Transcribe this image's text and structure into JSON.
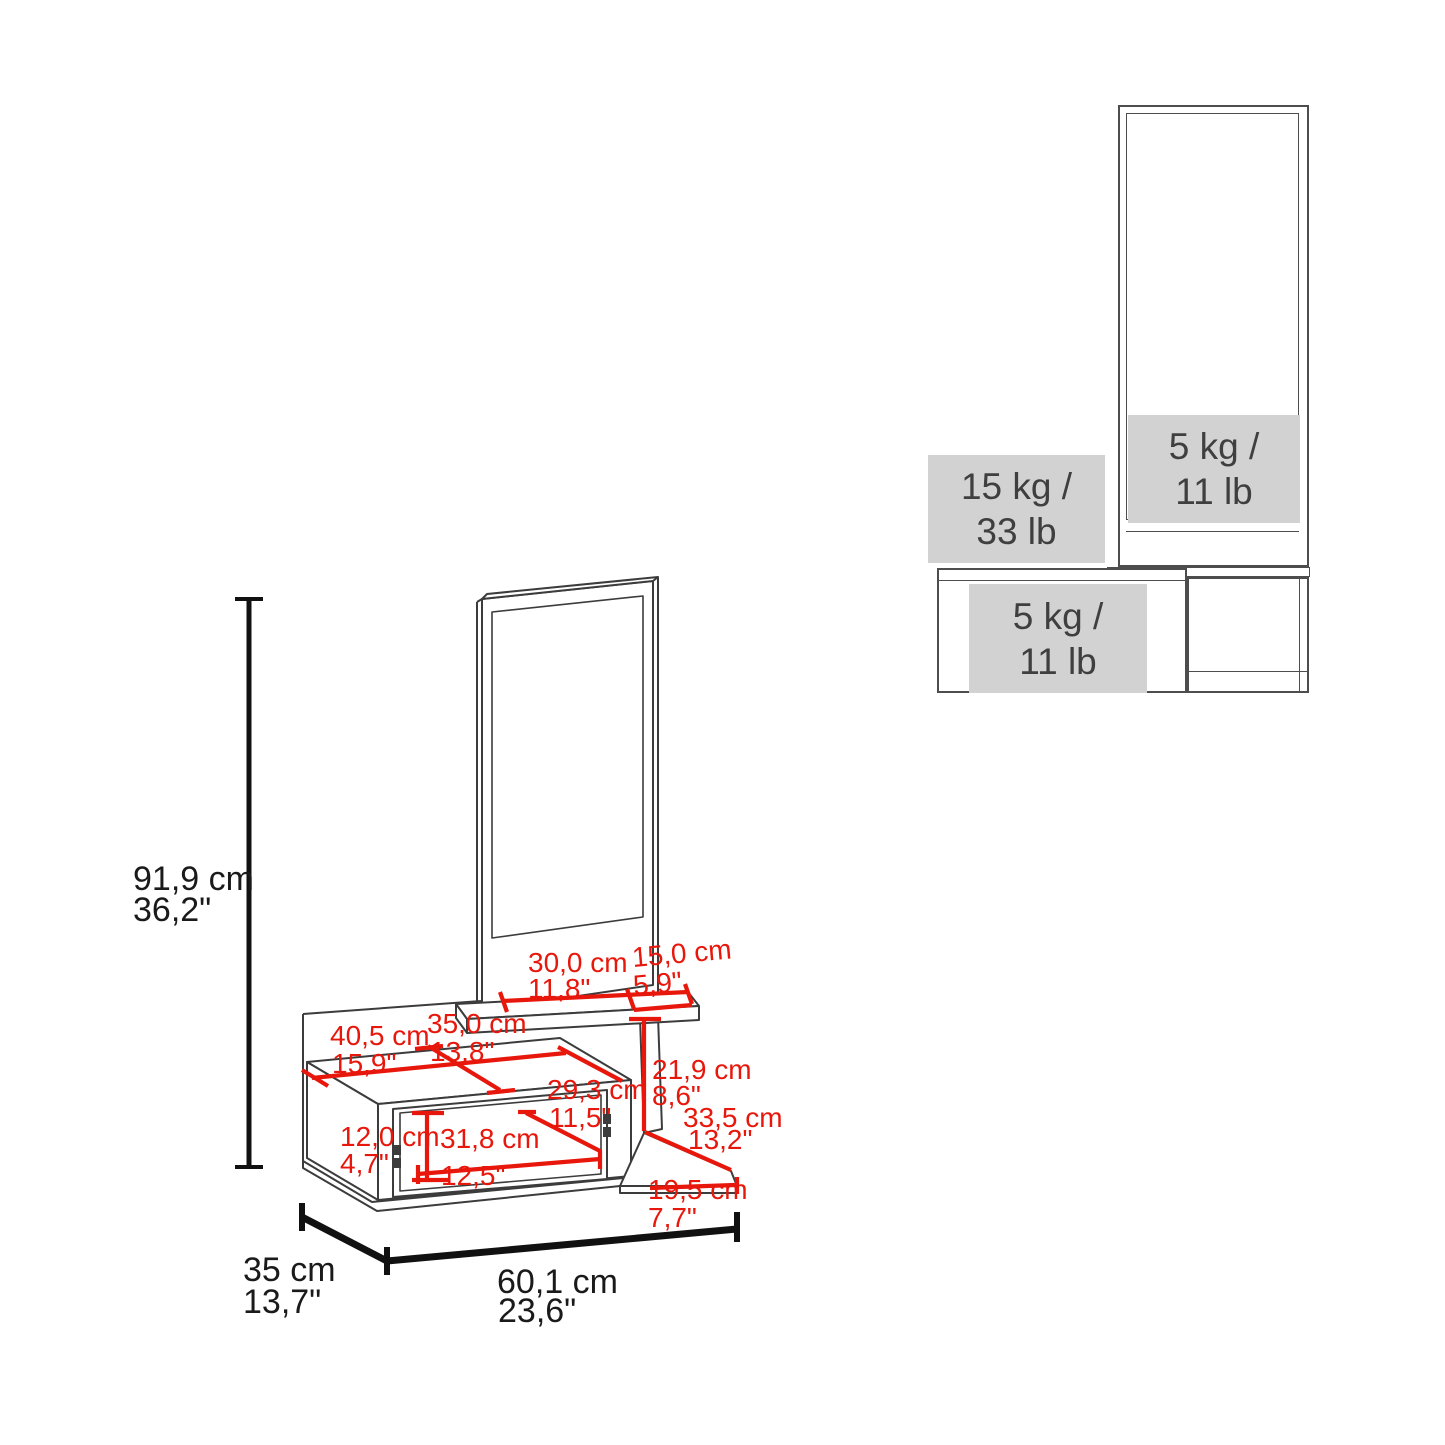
{
  "left_diagram": {
    "overall_height": {
      "cm": "91,9 cm",
      "inch": "36,2\""
    },
    "overall_depth": {
      "cm": "35 cm",
      "inch": "13,7\""
    },
    "overall_width": {
      "cm": "60,1 cm",
      "inch": "23,6\""
    },
    "top_shelf_left_section": {
      "cm": "30,0 cm",
      "inch": "11,8\""
    },
    "top_shelf_right_section": {
      "cm": "15,0 cm",
      "inch": "5,9\""
    },
    "cabinet_top_depth": {
      "cm": "35,0 cm",
      "inch": "13,8\""
    },
    "cabinet_top_width": {
      "cm": "40,5 cm",
      "inch": "15,9\""
    },
    "right_opening_height": {
      "cm": "21,9 cm",
      "inch": "8,6\""
    },
    "inner_diagonal": {
      "cm": "29,3 cm",
      "inch": "11,5\""
    },
    "lower_shelf_depth": {
      "cm": "33,5 cm",
      "inch": "13,2\""
    },
    "door_height": {
      "cm": "12,0 cm",
      "inch": "4,7\""
    },
    "door_width": {
      "cm": "31,8 cm",
      "inch": "12,5\""
    },
    "lower_shelf_width": {
      "cm": "19,5 cm",
      "inch": "7,7\""
    }
  },
  "right_diagram": {
    "mirror_shelf_capacity": {
      "line1": "5 kg /",
      "line2": "11 lb"
    },
    "top_shelf_capacity": {
      "line1": "15 kg /",
      "line2": "33 lb"
    },
    "drawer_capacity": {
      "line1": "5 kg /",
      "line2": "11 lb"
    }
  },
  "colors": {
    "dimension_red": "#e8170c",
    "outline_dark": "#3c3c3c",
    "capacity_fill": "#d2d2d2",
    "capacity_text": "#3f3f3f",
    "text_black": "#1a1a1a"
  }
}
